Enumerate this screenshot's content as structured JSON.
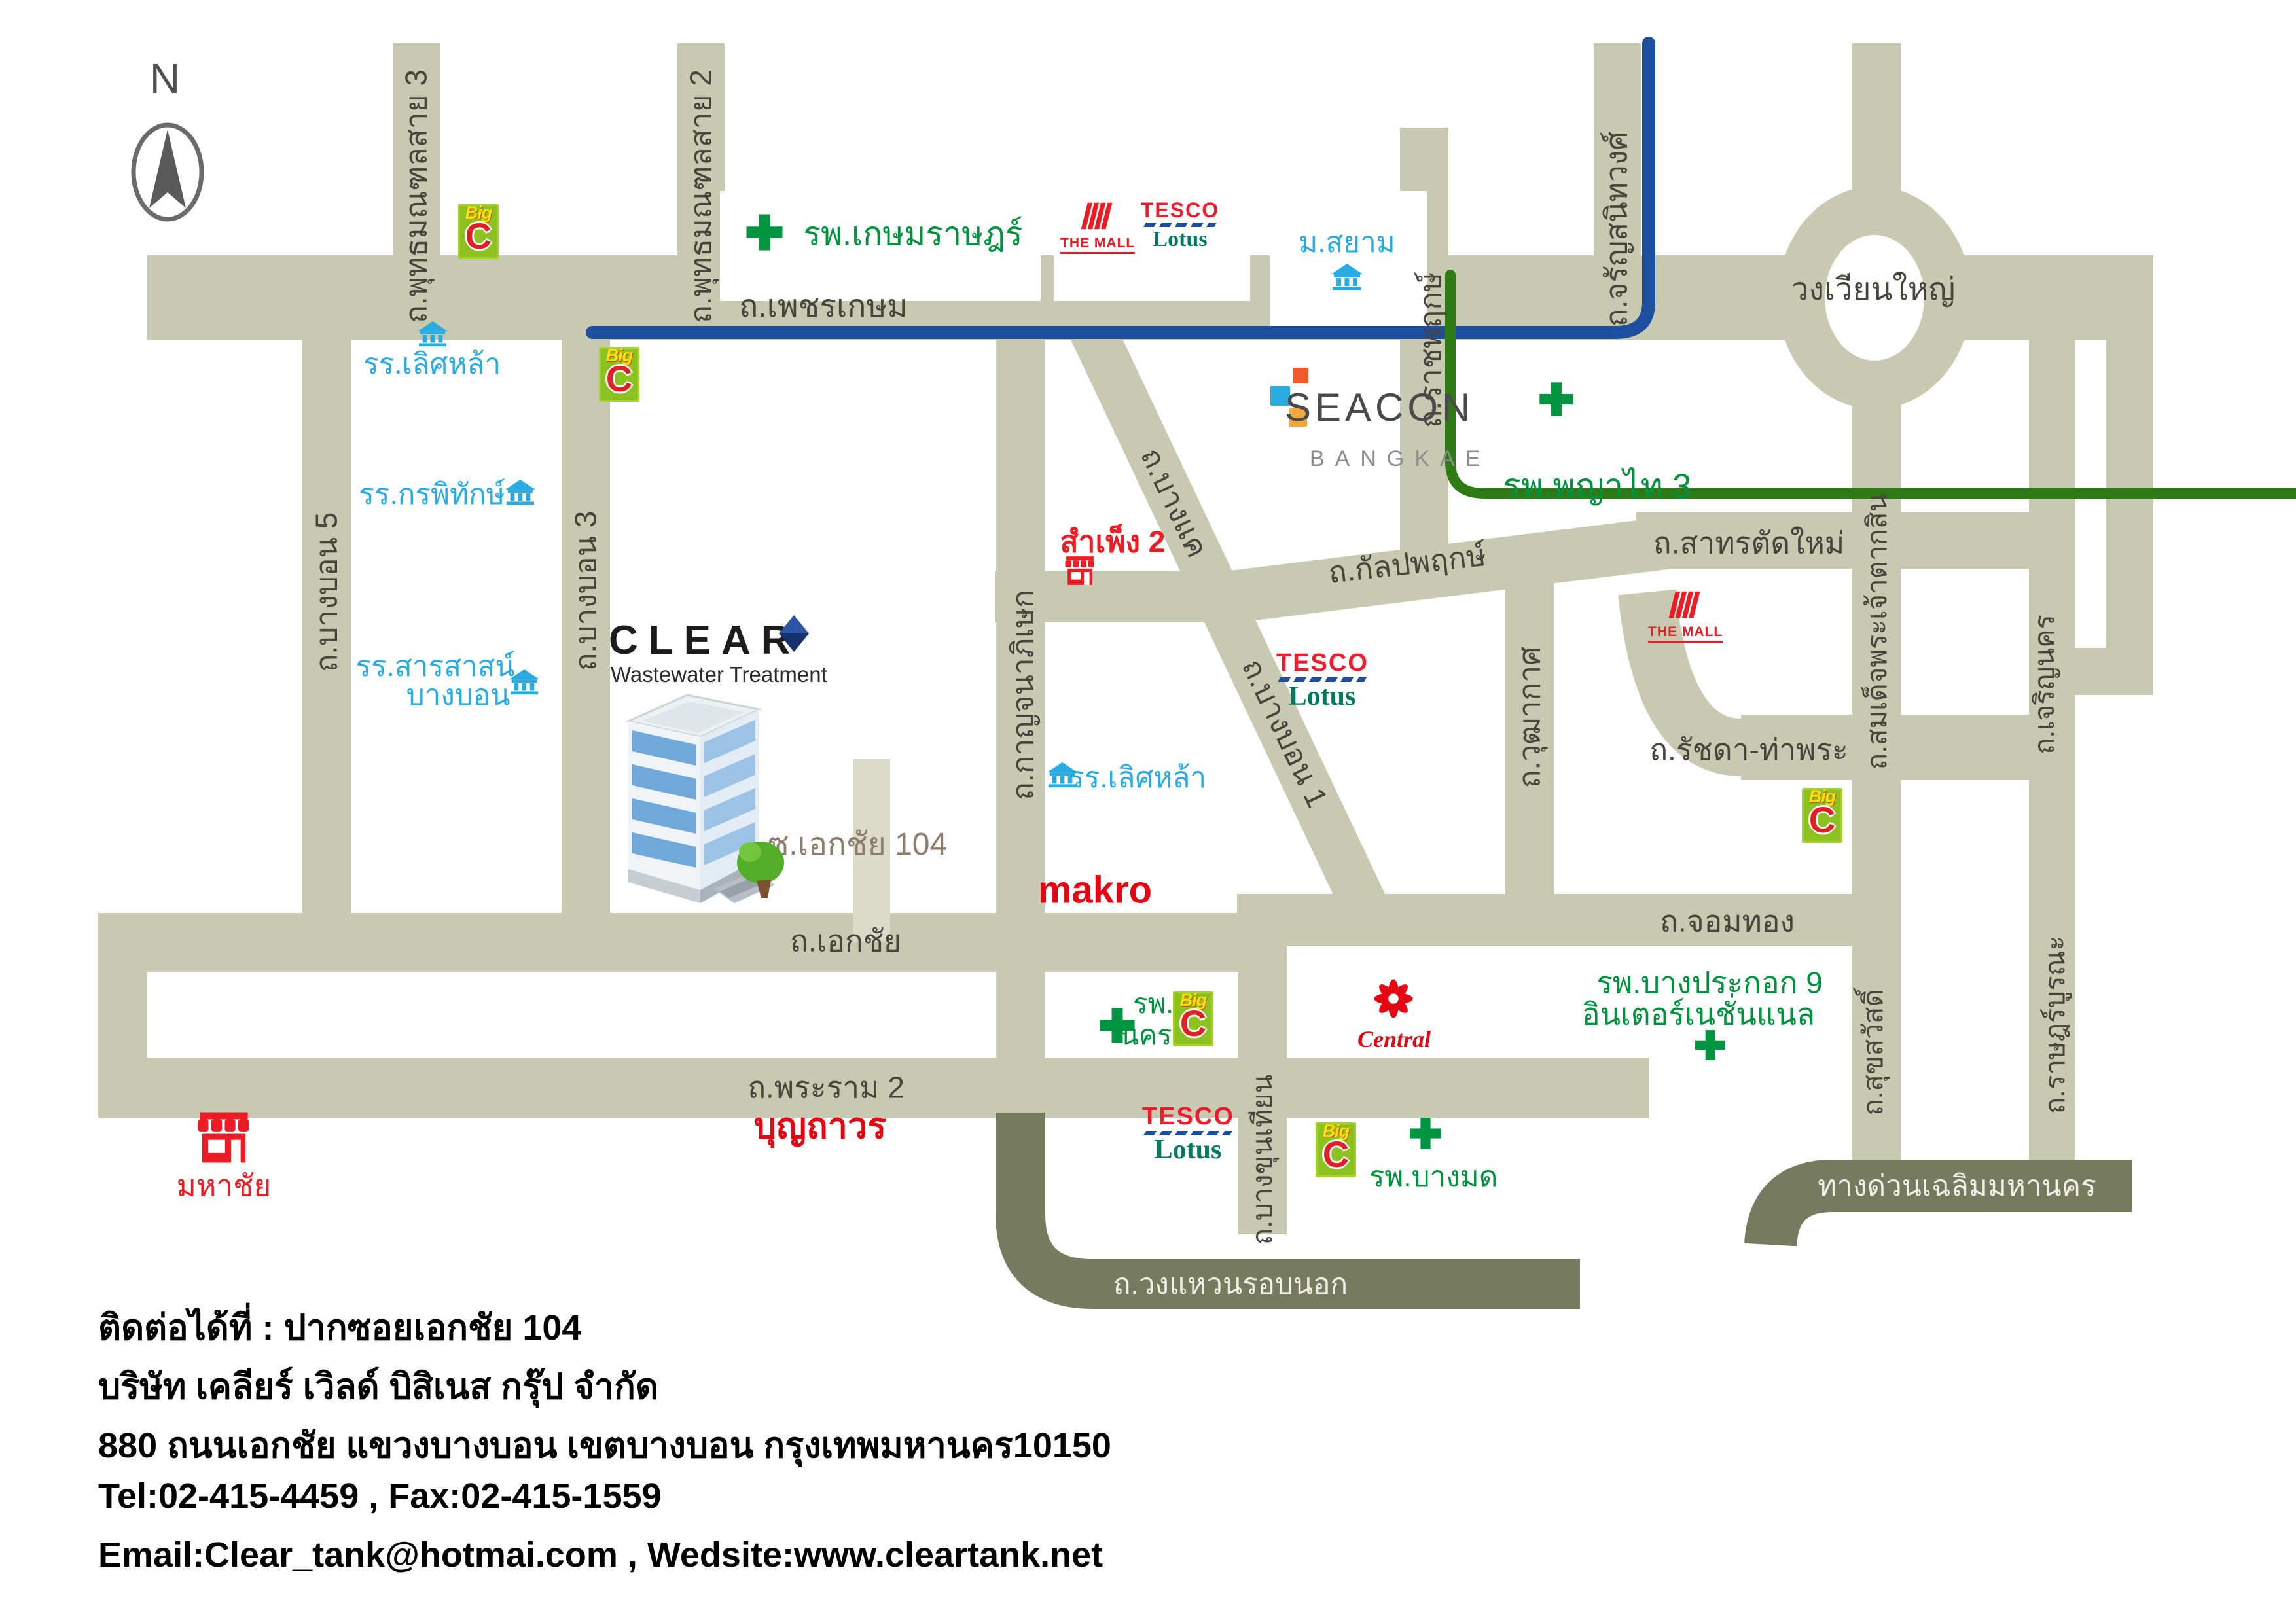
{
  "colors": {
    "road": "#c7cab0",
    "road_dark": "#767b5f",
    "soi_road": "#dadcc8",
    "route_blue": "#1d4f9e",
    "route_green": "#2e7a15",
    "school_blue": "#29abe2",
    "hospital_green": "#00913f",
    "brand_red": "#ed1c24",
    "road_label": "#45453b",
    "soi_label": "#8d7c6b"
  },
  "compass": {
    "north_label": "N"
  },
  "roads": {
    "phetkasem": "ถ.เพชรเกษม",
    "phutthamonthon3": "ถ.พุทธมณฑลสาย 3",
    "phutthamonthon2": "ถ.พุทธมณฑลสาย 2",
    "ratchaphruek": "ถ.ราชพฤกษ์",
    "charansanitwong": "ถ.จรัญสนิทวงศ์",
    "wongwianyai": "วงเวียนใหญ่",
    "bangbon5": "ถ.บางบอน 5",
    "bangbon3": "ถ.บางบอน 3",
    "kanchanaphisek": "ถ.กาญจนาภิเษก",
    "bangkhae": "ถ.บางแค",
    "bangbon1": "ถ.บางบอน 1",
    "kalpaphruek": "ถ.กัลปพฤกษ์",
    "sathon_tatmai": "ถ.สาทรตัดใหม่",
    "wuthakat": "ถ.วุฒากาศ",
    "somdet_taksin": "ถ.สมเด็จพระเจ้าตากสิน",
    "charoennakhon": "ถ.เจริญนคร",
    "ratchada_thapra": "ถ.รัชดา-ท่าพระ",
    "chomthong": "ถ.จอมทอง",
    "ekkachai": "ถ.เอกชัย",
    "soi_ekkachai104": "ซ.เอกชัย 104",
    "bangkhunthian": "ถ.บางขุนเทียน",
    "rama2": "ถ.พระราม 2",
    "suksawat": "ถ.สุขสวัสดิ์",
    "ratburana": "ถ.ราษฎร์บูรณะ",
    "wongwaen": "ถ.วงแหวนรอบนอก",
    "expressway": "ทางด่วนเฉลิมมหานคร"
  },
  "landmarks": {
    "kasemrat": "รพ.เกษมราษฎร์",
    "msiam": "ม.สยาม",
    "seacon": {
      "name": "SEACON",
      "sub": "BANGKAE"
    },
    "phayathai3": "รพ.พญาไท 3",
    "lertlah1": "รร.เลิศหล้า",
    "kornpitack": "รร.กรพิทักษ์",
    "sarasas_line1": "รร.สารสาสน์",
    "sarasas_line2": "บางบอน",
    "sampheng": "สำเพ็ง 2",
    "lertlah2": "รร.เลิศหล้า",
    "makro": "makro",
    "mahachai": "มหาชัย",
    "nakhonthon_line1": "รพ.",
    "nakhonthon_line2": "นครธน",
    "central": "Central",
    "bangpakok_line1": "รพ.บางประกอก 9",
    "bangpakok_line2": "อินเตอร์เนชั่นแนล",
    "boonthavorn": "บุญถาวร",
    "bangmod": "รพ.บางมด"
  },
  "company": {
    "name": "CLEAR",
    "subtitle": "Wastewater Treatment"
  },
  "logos": {
    "bigc": {
      "big": "Big",
      "c": "C"
    },
    "tesco": {
      "line1": "TESCO",
      "line2": "Lotus"
    },
    "themall": "THE MALL"
  },
  "contact": {
    "line1": "ติดต่อได้ที่ : ปากซอยเอกชัย 104",
    "line2": "บริษัท เคลียร์ เวิลด์ บิสิเนส กรุ๊ป จำกัด",
    "line3": "880 ถนนเอกชัย แขวงบางบอน เขตบางบอน กรุงเทพมหานคร10150",
    "line4": "Tel:02-415-4459 , Fax:02-415-1559",
    "line5": "Email:Clear_tank@hotmai.com , Wedsite:www.cleartank.net"
  }
}
